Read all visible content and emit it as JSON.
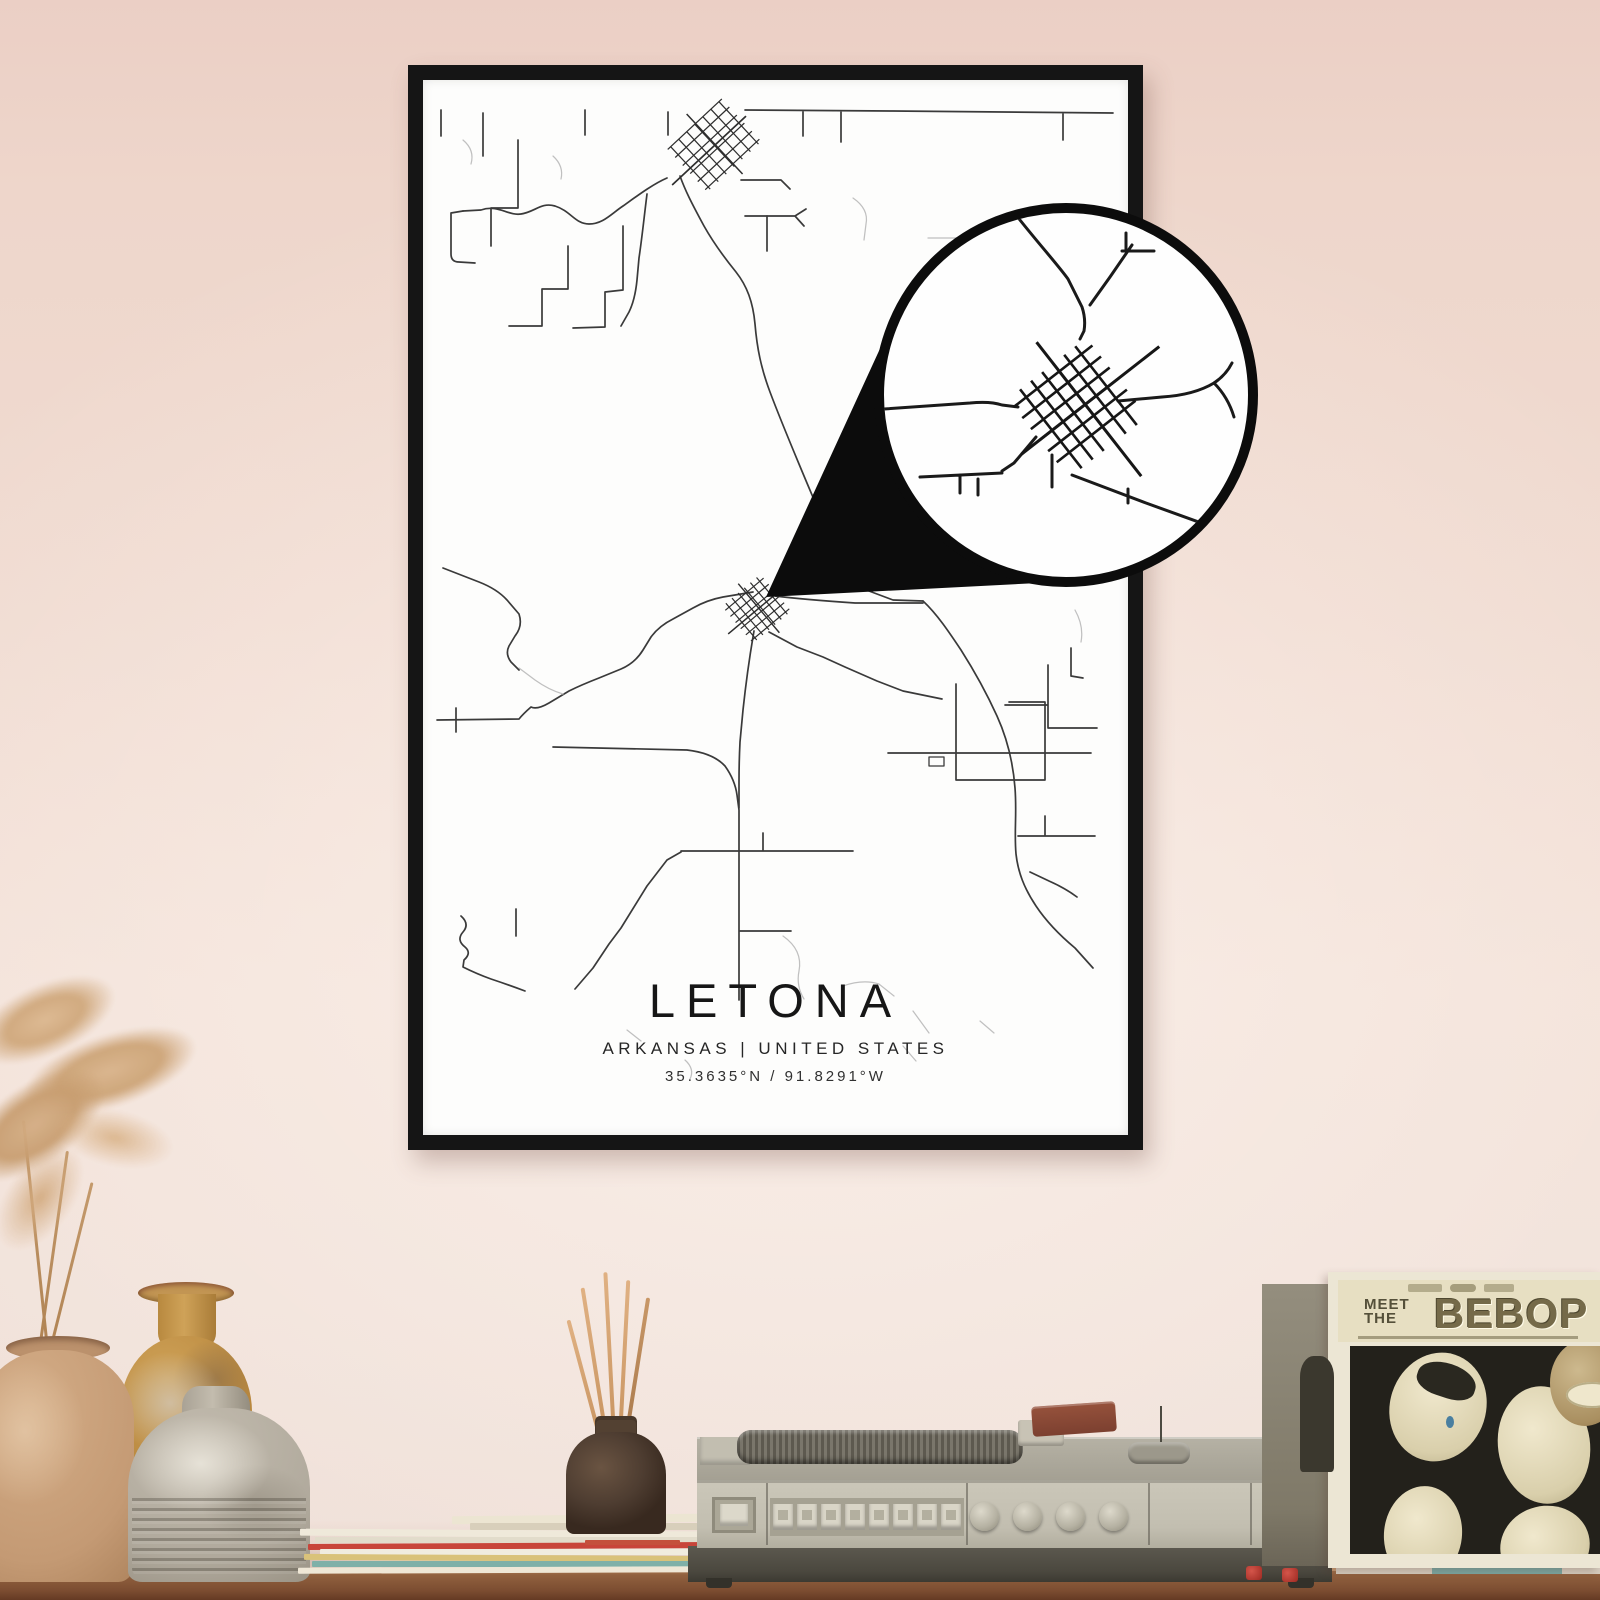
{
  "poster": {
    "city": "LETONA",
    "region_line": "ARKANSAS | UNITED STATES",
    "coordinates_line": "35.3635°N / 91.8291°W"
  },
  "record_sleeve": {
    "title_top": "MEET",
    "title_mid": "THE",
    "title_main": "BEBOP"
  },
  "colors": {
    "wall_pink": "#eed7cd",
    "frame_black": "#151515",
    "poster_white": "#fdfdfc",
    "road_dark": "#3a3a3a",
    "road_faint": "#c0c0c0",
    "callout_black": "#0c0c0c",
    "shelf_wood": "#91613f",
    "player_beige": "#c6c2b4",
    "sleeve_cream": "#e7dfc2",
    "sleeve_title_olive": "#756a49",
    "accent_red": "#b8352e",
    "vase_tan": "#c49a74",
    "vase_amber": "#c08b3f",
    "vase_gray": "#b0a99c",
    "diffuser_brown": "#4e3d31",
    "reed_tan": "#d4a377"
  }
}
